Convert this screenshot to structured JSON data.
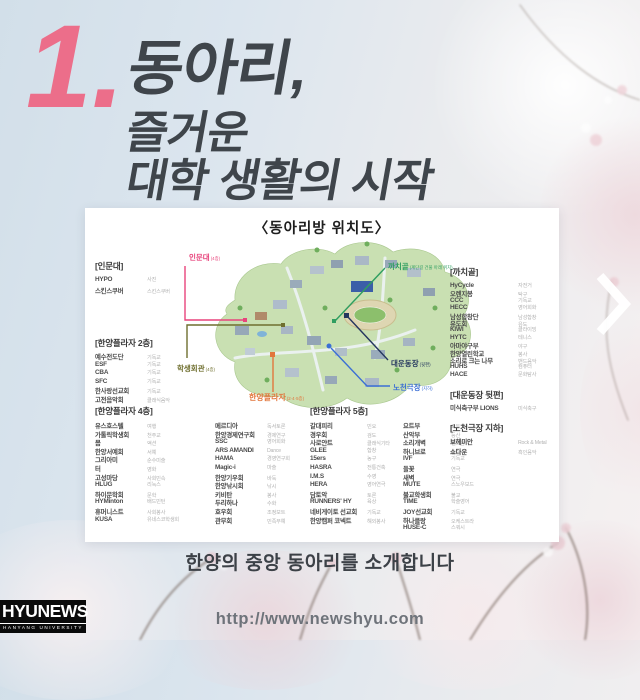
{
  "title": {
    "number": "1.",
    "line1": "동아리,",
    "line2": "즐거운",
    "line3": "대학 생활의 시작"
  },
  "card": {
    "title": "〈동아리방 위치도〉",
    "map": {
      "labels": {
        "inmun": {
          "text": "인문대",
          "note": "(4층)"
        },
        "hakgwan": {
          "text": "학생회관",
          "note": "(4층)"
        },
        "plaza": {
          "text": "한양플라자",
          "note": "(2·4·5층)"
        },
        "kkachi": {
          "text": "까치골",
          "note": "(계단길 건물 아래 위치)"
        },
        "stadium": {
          "text": "대운동장",
          "note": "(뒷편)"
        },
        "nocheon": {
          "text": "노천극장",
          "note": "(지하)"
        }
      }
    },
    "sections": {
      "inmundae": {
        "header": "[인문대]",
        "items": [
          {
            "name": "HYPO",
            "cat": "사진"
          },
          {
            "name": "스킨스쿠버",
            "cat": "스킨스쿠버"
          }
        ]
      },
      "plaza2": {
        "header": "[한양플라자 2층]",
        "items": [
          {
            "name": "예수전도단",
            "cat": "기독교"
          },
          {
            "name": "ESF",
            "cat": "기독교"
          },
          {
            "name": "CBA",
            "cat": "기독교"
          },
          {
            "name": "SFC",
            "cat": "기독교"
          },
          {
            "name": "한사랑선교회",
            "cat": "기독교"
          },
          {
            "name": "고전음악회",
            "cat": "클래식음악"
          }
        ]
      },
      "plaza4": {
        "header": "[한양플라자 4층]",
        "colA": [
          {
            "name": "유스호스텔",
            "cat": "여행"
          },
          {
            "name": "가톨릭학생회",
            "cat": "천주교"
          },
          {
            "name": "몸",
            "cat": "액션"
          },
          {
            "name": "한양서예회",
            "cat": "서예"
          },
          {
            "name": "그리아미",
            "cat": "순수미술"
          },
          {
            "name": "터",
            "cat": "영화"
          },
          {
            "name": "고성마당",
            "cat": "사회민속"
          },
          {
            "name": "HLUG",
            "cat": "리눅스"
          },
          {
            "name": "하이문학회",
            "cat": "문학"
          },
          {
            "name": "HYMinton",
            "cat": "배드민턴"
          },
          {
            "name": "휴머니스트",
            "cat": "사회봉사"
          },
          {
            "name": "KUSA",
            "cat": "유네스코학생회"
          }
        ],
        "colB": [
          {
            "name": "메르디아",
            "cat": "독서토론"
          },
          {
            "name": "한양경제연구회",
            "cat": "경제연구"
          },
          {
            "name": "SSC",
            "cat": "영어회화"
          },
          {
            "name": "ARS AMANDI",
            "cat": "Dance"
          },
          {
            "name": "HAMA",
            "cat": "경영연구회"
          },
          {
            "name": "Magic-i",
            "cat": "마술"
          },
          {
            "name": "한양기우회",
            "cat": "바둑"
          },
          {
            "name": "한양낚시회",
            "cat": "낚시"
          },
          {
            "name": "키비탄",
            "cat": "봉사"
          },
          {
            "name": "두리하나",
            "cat": "수화"
          },
          {
            "name": "호우회",
            "cat": "조정보트"
          },
          {
            "name": "관무회",
            "cat": "민족무예"
          }
        ]
      },
      "plaza5": {
        "header": "[한양플라자 5층]",
        "colC": [
          {
            "name": "갈대피리",
            "cat": "민요"
          },
          {
            "name": "경우회",
            "cat": "검도"
          },
          {
            "name": "사로얀트",
            "cat": "클래식기타"
          },
          {
            "name": "GLEE",
            "cat": "합창"
          },
          {
            "name": "15ers",
            "cat": "농구"
          },
          {
            "name": "HASRA",
            "cat": "전통건축"
          },
          {
            "name": "I.M.S",
            "cat": "수영"
          },
          {
            "name": "HERA",
            "cat": "영어연극"
          },
          {
            "name": "담토악",
            "cat": "토론"
          },
          {
            "name": "RUNNERS' HY",
            "cat": "육상"
          },
          {
            "name": "네비게이토 선교회",
            "cat": "기독교"
          },
          {
            "name": "한양캠퍼 코넥트",
            "cat": "해외봉사"
          }
        ],
        "colD": [
          {
            "name": "요트부",
            "cat": "요트"
          },
          {
            "name": "산악부",
            "cat": "등산"
          },
          {
            "name": "소리개벽",
            "cat": "밴드음악"
          },
          {
            "name": "하니브로",
            "cat": "힙합"
          },
          {
            "name": "IVF",
            "cat": "기독교"
          },
          {
            "name": "들꽃",
            "cat": "연극"
          },
          {
            "name": "새벽",
            "cat": "연극"
          },
          {
            "name": "MUTE",
            "cat": "스노우보드"
          },
          {
            "name": "불교학생회",
            "cat": "불교"
          },
          {
            "name": "TIME",
            "cat": "학술영어"
          },
          {
            "name": "JOY선교회",
            "cat": "기독교"
          },
          {
            "name": "하나클랑",
            "cat": "오케스트라"
          },
          {
            "name": "HUSE-C",
            "cat": "스쿼시"
          }
        ]
      },
      "kkachigol": {
        "header": "[까치골]",
        "items": [
          {
            "name": "HyCycle",
            "cat": "자전거"
          },
          {
            "name": "오렌지봉",
            "cat": "탁구"
          },
          {
            "name": "CCC",
            "cat": "기독교"
          },
          {
            "name": "HECC",
            "cat": "영어회화"
          },
          {
            "name": "남성합창단",
            "cat": "남성합창"
          },
          {
            "name": "유도회",
            "cat": "유도"
          },
          {
            "name": "KIWI",
            "cat": "클라이밍"
          },
          {
            "name": "HYTC",
            "cat": "테니스"
          },
          {
            "name": "아마야구부",
            "cat": "야구"
          },
          {
            "name": "한양열린학교",
            "cat": "봉사"
          },
          {
            "name": "소리로 크는 나무",
            "cat": "밴드음악"
          },
          {
            "name": "HUHS",
            "cat": "컴퓨터"
          },
          {
            "name": "HACE",
            "cat": "문화탐사"
          }
        ]
      },
      "stadium": {
        "header": "[대운동장 뒷편]",
        "items": [
          {
            "name": "미식축구부 LIONS",
            "cat": "미식축구"
          }
        ]
      },
      "nocheon": {
        "header": "[노천극장 지하]",
        "items": [
          {
            "name": "보헤미안",
            "cat": "Rock & Metal"
          },
          {
            "name": "쇼다운",
            "cat": "흑인음악"
          }
        ]
      }
    }
  },
  "caption": {
    "text": "한양의 중앙 동아리를 소개합니다"
  },
  "footer": {
    "url": "http://www.newshyu.com",
    "logo_text": "HYUNEWS",
    "logo_subtext": "HANYANG UNIVERSITY"
  },
  "nav": {
    "next_icon": "chevron-right"
  },
  "colors": {
    "accent_pink": "#ec6e8a",
    "title_text": "#3f454b",
    "label_inmun": "#e8447c",
    "label_hakgwan": "#6f6f2f",
    "label_plaza": "#e2763c",
    "label_kkachi": "#2f9e60",
    "label_stadium": "#24365e",
    "label_nocheon": "#3b6fd4"
  }
}
